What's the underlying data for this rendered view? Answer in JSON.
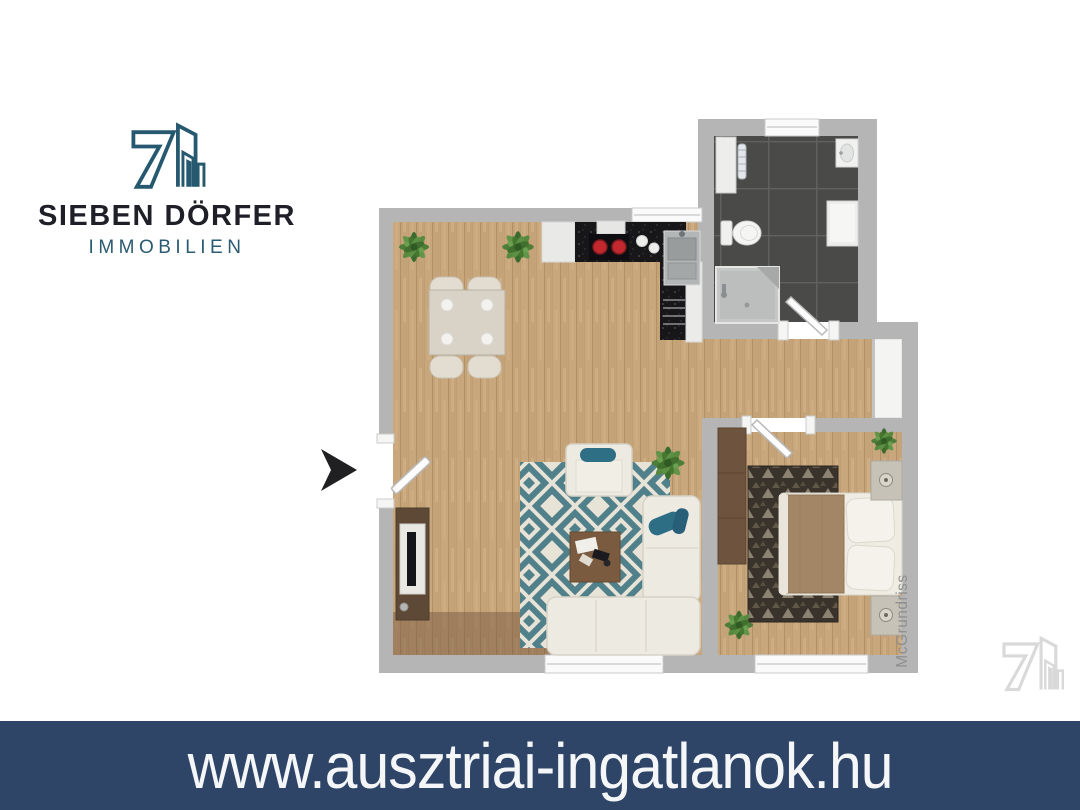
{
  "brand": {
    "line1": "SIEBEN DÖRFER",
    "line2": "IMMOBILIEN",
    "accent_color": "#26586F",
    "dark_color": "#1E1F27"
  },
  "floorplan": {
    "watermark_text": "McGrundriss",
    "wall_color": "#B5B5B6",
    "wood_color": "#C9A77D",
    "tile_color": "#4A4A48",
    "rug_teal_color": "#50808A",
    "entrance_marker": "black-arrow",
    "rooms": [
      {
        "name": "living-dining-kitchen",
        "furniture": [
          "dining-table",
          "four-dining-chairs",
          "kitchen-counter",
          "stove-with-red-burners",
          "sink",
          "range-hood",
          "corner-sofa",
          "armchair",
          "coffee-table",
          "diamond-pattern-rug",
          "tv-sideboard",
          "potted-plants"
        ]
      },
      {
        "name": "bathroom",
        "furniture": [
          "shower",
          "toilet",
          "washbasin",
          "towel-radiator",
          "wall-cabinet",
          "shelf-niche",
          "window"
        ]
      },
      {
        "name": "hallway",
        "furniture": [
          "niche"
        ]
      },
      {
        "name": "bedroom",
        "furniture": [
          "double-bed",
          "brown-duvet",
          "pillows",
          "two-nightstands",
          "lamps",
          "wardrobe",
          "patterned-dark-rug",
          "potted-plants",
          "window"
        ]
      }
    ]
  },
  "banner": {
    "url": "www.ausztriai-ingatlanok.hu",
    "background": "#2E4568",
    "text_color": "#F5F6F8"
  }
}
